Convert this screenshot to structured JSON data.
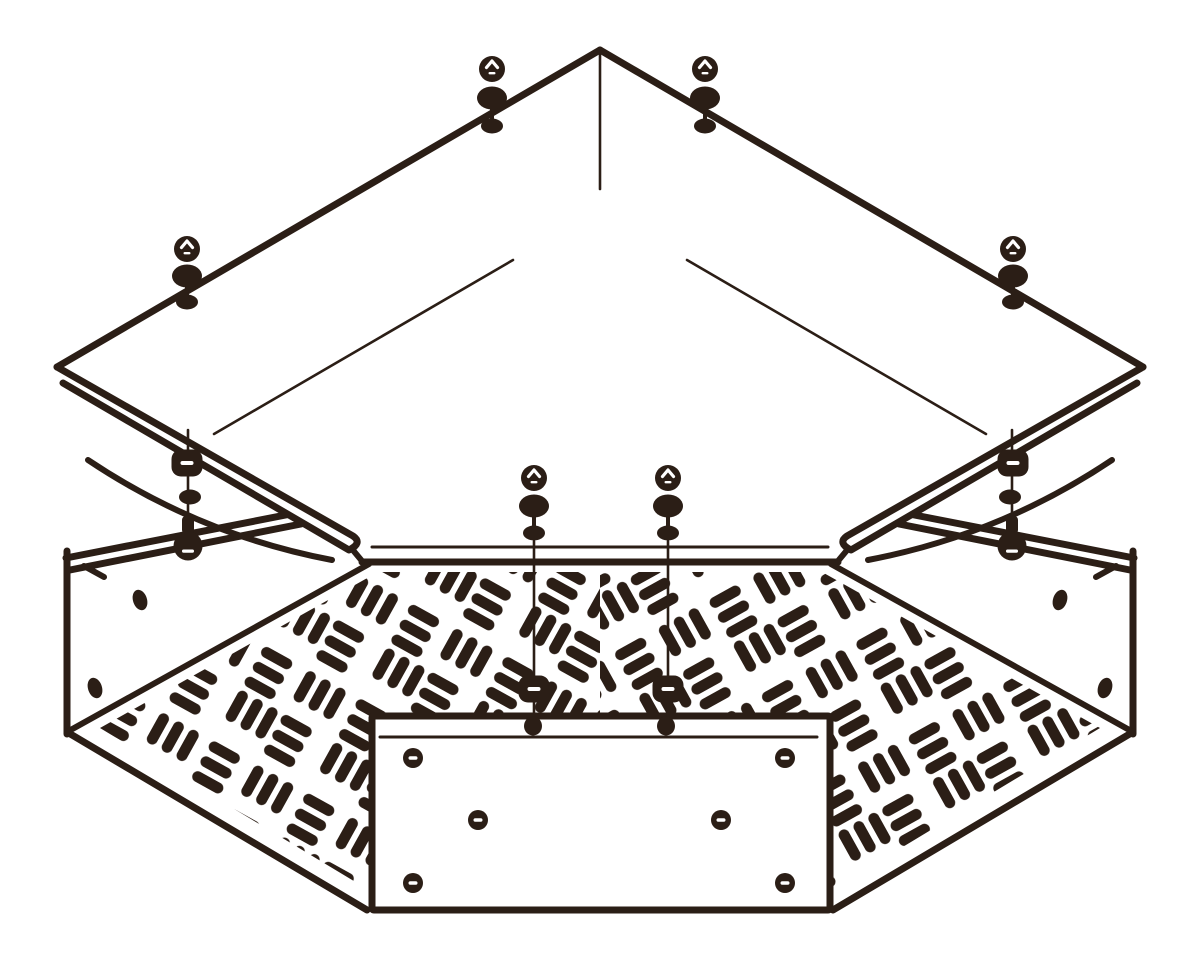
{
  "canvas": {
    "width": 1200,
    "height": 964,
    "background": "#ffffff",
    "ink": "#2b1e16",
    "white": "#ffffff"
  },
  "floor_pattern": {
    "tile": 108,
    "slot_length": 34,
    "slot_width": 11,
    "slot_radius": 5.5,
    "pitch": 17,
    "block_offset": 54,
    "inner_margin": 4,
    "rotation_left": 29,
    "rotation_right": -29
  },
  "shapes": [
    {
      "t": "ppoly",
      "n": "floor-perforation-field-left",
      "pts": "100,728 378,572 600,572 600,898 382,898",
      "pat": "patternLeft"
    },
    {
      "t": "ppoly",
      "n": "floor-perforation-field-right",
      "pts": "1100,728 822,572 600,572 600,898 818,898",
      "pat": "patternRight"
    },
    {
      "t": "rect",
      "n": "access-plate",
      "x": 372,
      "y": 716,
      "wd": 458,
      "ht": 194,
      "rx": 2,
      "f": "#ffffff",
      "sw": 7
    },
    {
      "t": "line",
      "n": "access-plate-hem-line",
      "x1": 380,
      "y1": 737,
      "x2": 817,
      "y2": 737,
      "w": 3
    },
    {
      "t": "slothole",
      "n": "plate-rivet-top-left",
      "cx": 413,
      "cy": 758
    },
    {
      "t": "slothole",
      "n": "plate-rivet-top-right",
      "cx": 785,
      "cy": 758
    },
    {
      "t": "slothole",
      "n": "plate-rivet-mid-left",
      "cx": 478,
      "cy": 820
    },
    {
      "t": "slothole",
      "n": "plate-rivet-mid-right",
      "cx": 721,
      "cy": 820
    },
    {
      "t": "slothole",
      "n": "plate-rivet-bottom-left",
      "cx": 413,
      "cy": 883
    },
    {
      "t": "slothole",
      "n": "plate-rivet-bottom-right",
      "cx": 785,
      "cy": 883
    },
    {
      "t": "line",
      "n": "left-wall-top-hem-outer",
      "x1": 66,
      "y1": 558,
      "x2": 301,
      "y2": 512,
      "w": 7
    },
    {
      "t": "line",
      "n": "left-wall-top-hem-inner",
      "x1": 70,
      "y1": 570,
      "x2": 301,
      "y2": 524,
      "w": 7
    },
    {
      "t": "line",
      "n": "left-wall-hem-tick",
      "x1": 84,
      "y1": 566,
      "x2": 104,
      "y2": 577,
      "w": 6
    },
    {
      "t": "line",
      "n": "left-wall-corner-edge",
      "x1": 67,
      "y1": 551,
      "x2": 67,
      "y2": 734,
      "w": 7
    },
    {
      "t": "line",
      "n": "left-floor-back-edge",
      "x1": 369,
      "y1": 564,
      "x2": 67,
      "y2": 732,
      "w": 6
    },
    {
      "t": "line",
      "n": "left-floor-front-edge",
      "x1": 67,
      "y1": 732,
      "x2": 367,
      "y2": 910,
      "w": 7
    },
    {
      "t": "line",
      "n": "right-wall-top-hem-outer",
      "x1": 1134,
      "y1": 558,
      "x2": 899,
      "y2": 512,
      "w": 7
    },
    {
      "t": "line",
      "n": "right-wall-top-hem-inner",
      "x1": 1130,
      "y1": 570,
      "x2": 899,
      "y2": 524,
      "w": 7
    },
    {
      "t": "line",
      "n": "right-wall-hem-tick",
      "x1": 1116,
      "y1": 566,
      "x2": 1096,
      "y2": 577,
      "w": 6
    },
    {
      "t": "line",
      "n": "right-wall-corner-edge",
      "x1": 1133,
      "y1": 551,
      "x2": 1133,
      "y2": 734,
      "w": 7
    },
    {
      "t": "line",
      "n": "right-floor-back-edge",
      "x1": 831,
      "y1": 564,
      "x2": 1133,
      "y2": 732,
      "w": 6
    },
    {
      "t": "line",
      "n": "right-floor-front-edge",
      "x1": 1133,
      "y1": 732,
      "x2": 833,
      "y2": 910,
      "w": 7
    },
    {
      "t": "ellipse",
      "n": "left-wall-hole-upper",
      "cx": 140,
      "cy": 600,
      "rx": 7,
      "ry": 10.5,
      "rot": -18
    },
    {
      "t": "ellipse",
      "n": "left-wall-hole-lower",
      "cx": 95,
      "cy": 688,
      "rx": 7,
      "ry": 10.5,
      "rot": -18
    },
    {
      "t": "ellipse",
      "n": "right-wall-hole-upper",
      "cx": 1060,
      "cy": 600,
      "rx": 7,
      "ry": 10.5,
      "rot": 18
    },
    {
      "t": "ellipse",
      "n": "right-wall-hole-lower",
      "cx": 1105,
      "cy": 688,
      "rx": 7,
      "ry": 10.5,
      "rot": 18
    },
    {
      "t": "line",
      "n": "lid-ridge-crease",
      "x1": 600,
      "y1": 53,
      "x2": 600,
      "y2": 189,
      "w": 2.6
    },
    {
      "t": "line",
      "n": "lid-left-fold-crease",
      "x1": 214,
      "y1": 434,
      "x2": 513,
      "y2": 260,
      "w": 2.6
    },
    {
      "t": "line",
      "n": "lid-right-fold-crease",
      "x1": 687,
      "y1": 260,
      "x2": 986,
      "y2": 434,
      "w": 2.6
    },
    {
      "t": "path",
      "n": "lid-left-skirt-edge",
      "d": "M88,460 Q200,535 332,560",
      "w": 6
    },
    {
      "t": "path",
      "n": "lid-right-skirt-edge",
      "d": "M1112,460 Q1000,535 868,560",
      "w": 6
    },
    {
      "t": "line",
      "n": "lid-left-band-mask",
      "x1": 60,
      "y1": 373,
      "x2": 354,
      "y2": 542,
      "w": 22,
      "s": "#ffffff"
    },
    {
      "t": "line",
      "n": "lid-right-band-mask",
      "x1": 1140,
      "y1": 373,
      "x2": 846,
      "y2": 542,
      "w": 22,
      "s": "#ffffff"
    },
    {
      "t": "rect",
      "n": "lid-front-bar-mask",
      "x": 360,
      "y": 541,
      "wd": 480,
      "ht": 22,
      "rx": 0,
      "f": "#ffffff"
    },
    {
      "t": "line",
      "n": "lid-front-bar-top",
      "x1": 372,
      "y1": 547,
      "x2": 828,
      "y2": 547,
      "w": 3
    },
    {
      "t": "line",
      "n": "lid-front-bar-bottom",
      "x1": 362,
      "y1": 562,
      "x2": 838,
      "y2": 562,
      "w": 7
    },
    {
      "t": "line",
      "n": "lid-front-bar-hook-left",
      "x1": 362,
      "y1": 561,
      "x2": 352,
      "y2": 549,
      "w": 6
    },
    {
      "t": "line",
      "n": "lid-front-bar-hook-right",
      "x1": 838,
      "y1": 561,
      "x2": 848,
      "y2": 549,
      "w": 6
    },
    {
      "t": "path",
      "n": "lid-left-edge-hem",
      "d": "M57,367 L353,536 Q363,543 349,550 L63,383",
      "w": 7
    },
    {
      "t": "path",
      "n": "lid-right-edge-hem",
      "d": "M1143,367 L847,536 Q837,543 851,550 L1137,383",
      "w": 7
    },
    {
      "t": "line",
      "n": "lid-upper-left-edge",
      "x1": 600,
      "y1": 50,
      "x2": 57,
      "y2": 367,
      "w": 7
    },
    {
      "t": "line",
      "n": "lid-upper-right-edge",
      "x1": 600,
      "y1": 50,
      "x2": 1143,
      "y2": 367,
      "w": 7
    },
    {
      "t": "line",
      "n": "left-corner-bolt-shank",
      "x1": 188,
      "y1": 430,
      "x2": 188,
      "y2": 519,
      "w": 2.6
    },
    {
      "t": "line",
      "n": "right-corner-bolt-shank",
      "x1": 1012,
      "y1": 430,
      "x2": 1012,
      "y2": 519,
      "w": 2.6
    },
    {
      "t": "swasher",
      "n": "left-corner-slotted-washer",
      "cx": 187,
      "cy": 463
    },
    {
      "t": "swasher",
      "n": "right-corner-slotted-washer",
      "cx": 1013,
      "cy": 463
    },
    {
      "t": "ellipse",
      "n": "left-corner-washer",
      "cx": 190,
      "cy": 497,
      "rx": 11,
      "ry": 7.5,
      "rot": 0
    },
    {
      "t": "ellipse",
      "n": "right-corner-washer",
      "cx": 1010,
      "cy": 497,
      "rx": 11,
      "ry": 7.5,
      "rot": 0
    },
    {
      "t": "bulb",
      "n": "left-corner-machine-screw",
      "cx": 188,
      "cy": 546
    },
    {
      "t": "bulb",
      "n": "right-corner-machine-screw",
      "cx": 1012,
      "cy": 546
    },
    {
      "t": "screwstack",
      "n": "lid-screw-upper-left-1",
      "cx": 492,
      "yh": 69,
      "yw": 98,
      "yn": 126
    },
    {
      "t": "screwstack",
      "n": "lid-screw-upper-right-1",
      "cx": 705,
      "yh": 69,
      "yw": 98,
      "yn": 126
    },
    {
      "t": "screwstack",
      "n": "lid-screw-upper-left-2",
      "cx": 187,
      "yh": 249,
      "yw": 276,
      "yn": 302
    },
    {
      "t": "screwstack",
      "n": "lid-screw-upper-right-2",
      "cx": 1013,
      "yh": 249,
      "yw": 276,
      "yn": 302
    },
    {
      "t": "line",
      "n": "center-screw-shank-left",
      "x1": 534,
      "y1": 541,
      "x2": 534,
      "y2": 722,
      "w": 2.6
    },
    {
      "t": "line",
      "n": "center-screw-shank-right",
      "x1": 668,
      "y1": 541,
      "x2": 668,
      "y2": 722,
      "w": 2.6
    },
    {
      "t": "screwstack",
      "n": "center-screw-left",
      "cx": 534,
      "yh": 478,
      "yw": 506,
      "yn": 533
    },
    {
      "t": "screwstack",
      "n": "center-screw-right",
      "cx": 668,
      "yh": 478,
      "yw": 506,
      "yn": 533
    },
    {
      "t": "swasher",
      "n": "floor-slotted-nut-left",
      "cx": 534,
      "cy": 689
    },
    {
      "t": "swasher",
      "n": "floor-slotted-nut-right",
      "cx": 668,
      "cy": 689
    },
    {
      "t": "ellipse",
      "n": "plate-stud-left",
      "cx": 533,
      "cy": 726,
      "rx": 9,
      "ry": 9.5,
      "rot": 0
    },
    {
      "t": "ellipse",
      "n": "plate-stud-right",
      "cx": 666,
      "cy": 726,
      "rx": 9,
      "ry": 9.5,
      "rot": 0
    }
  ]
}
